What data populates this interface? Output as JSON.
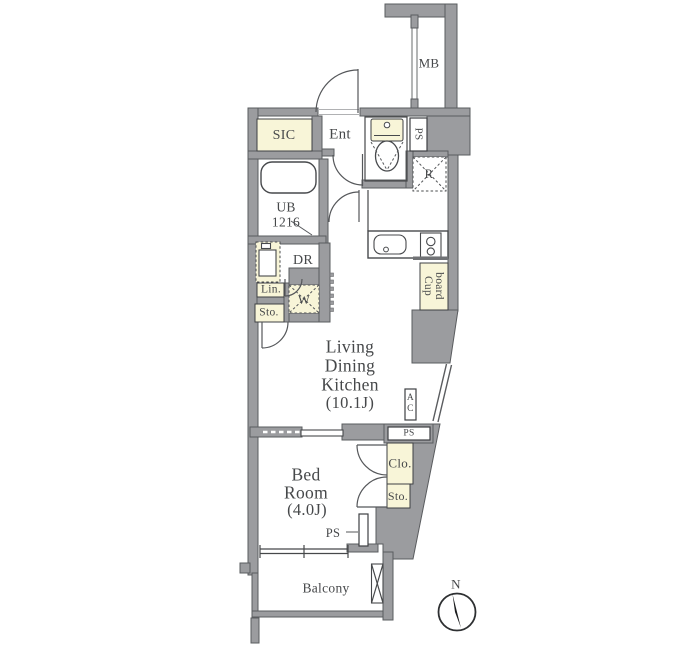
{
  "floorplan": {
    "labels": {
      "mb": "MB",
      "ps_top": "PS",
      "sic": "SIC",
      "ent": "Ent",
      "refrigerator": "R",
      "ub_line1": "UB",
      "ub_line2": "1216",
      "dr": "DR",
      "lin": "Lin.",
      "washer": "W",
      "sto_left": "Sto.",
      "cupboard_line1": "Cup",
      "cupboard_line2": "board",
      "ldk_line1": "Living",
      "ldk_line2": "Dining",
      "ldk_line3": "Kitchen",
      "ldk_line4": "(10.1J)",
      "ac_line1": "A",
      "ac_line2": "C",
      "ps_middle": "PS",
      "clo": "Clo.",
      "sto_right": "Sto.",
      "bed_line1": "Bed",
      "bed_line2": "Room",
      "bed_line3": "(4.0J)",
      "ps_bottom": "PS",
      "balcony": "Balcony",
      "compass_north": "N"
    },
    "colors": {
      "wall_fill": "#9b9c9f",
      "wall_stroke": "#5a5c5f",
      "accent_room_fill": "#f8f5d8",
      "line": "#46484a",
      "text": "#46484a",
      "background": "#ffffff"
    }
  }
}
